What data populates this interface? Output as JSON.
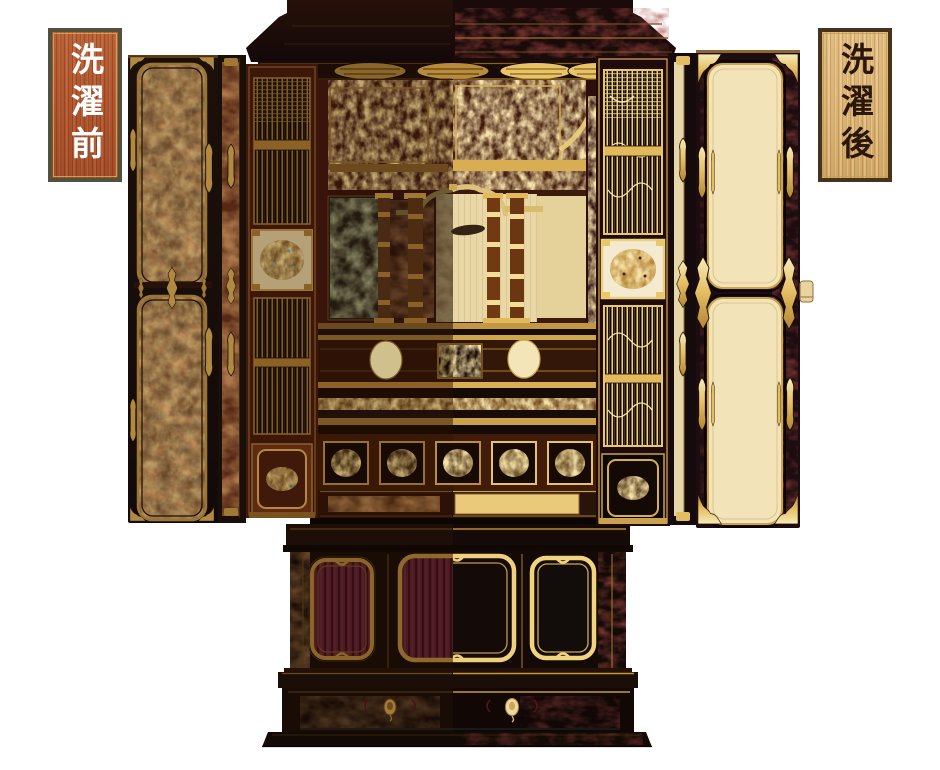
{
  "page": {
    "background_color": "#ffffff"
  },
  "labels": {
    "before": {
      "text": "洗濯前",
      "text_color": "#ffffff",
      "panel_color": "#b2572f",
      "frame_color": "#53503e",
      "inner_line_color": "#c9a24c"
    },
    "after": {
      "text": "洗濯後",
      "text_color": "#2a160a",
      "panel_color": "#dcb474",
      "frame_color": "#45321f",
      "inner_line_color": "#c9a24c"
    }
  },
  "figure": {
    "subject": "Gilded Buddhist home altar (butsudan) with doors open, lower cabinet and plinth; left half shown before cleaning (dull and worn), right half after cleaning (bright gold and black lacquer)",
    "before_side": "left",
    "after_side": "right",
    "palette": {
      "lacquer_black": "#150a08",
      "worn_lacquer": "#2a1409",
      "worn_gold": "#9a7434",
      "bright_gold": "#e8c36a",
      "pale_gold": "#f4dc96",
      "cream_panel": "#f2e4b8",
      "worn_red": "#6b3a1c",
      "maroon_panel": "#4e1a24",
      "interior_red": "#40180a"
    }
  }
}
